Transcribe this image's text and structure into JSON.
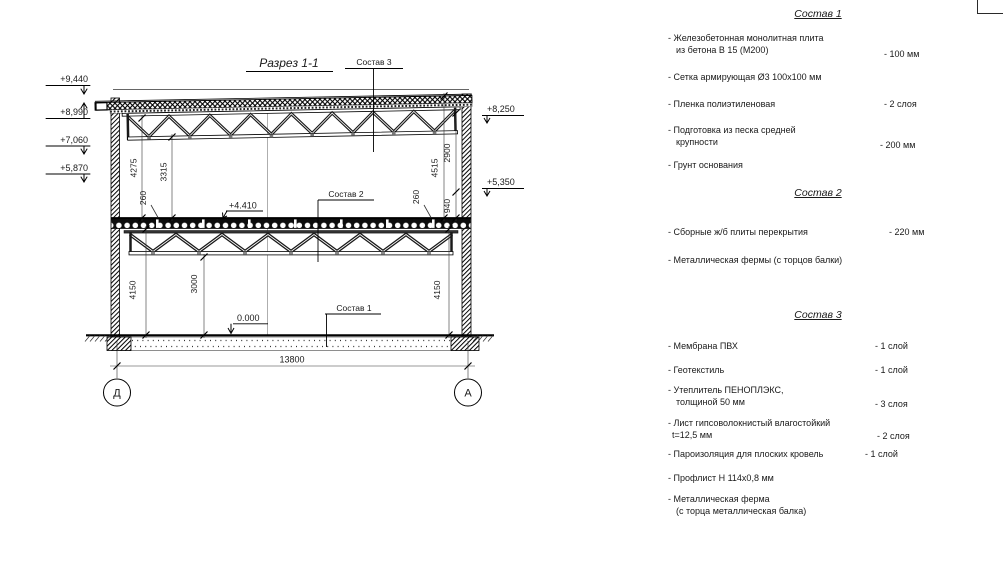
{
  "section": {
    "title": "Разрез 1-1",
    "callouts": {
      "c1": "Состав 1",
      "c2": "Состав 2",
      "c3": "Состав 3"
    },
    "elevations": {
      "e9440": "+9,440",
      "e8990": "+8,990",
      "e7060": "+7,060",
      "e5870": "+5,870",
      "e8250": "+8,250",
      "e5350": "+5,350",
      "e4410": "+4.410",
      "e0": "0.000"
    },
    "dims": {
      "d4275": "4275",
      "d3315": "3315",
      "d260l": "260",
      "d4515": "4515",
      "d2900": "2900",
      "d940": "940",
      "d260r": "260",
      "d4150l": "4150",
      "d3000": "3000",
      "d4150r": "4150",
      "d13800": "13800"
    },
    "axes": {
      "left": "Д",
      "right": "А"
    }
  },
  "specs": [
    {
      "title": "Состав 1",
      "items": [
        {
          "l1": "- Железобетонная  монолитная плита",
          "l2": "из бетона В 15 (М200)",
          "v": "- 100 мм"
        },
        {
          "l1": "- Сетка армирующая Ø3 100x100 мм"
        },
        {
          "l1": "- Пленка полиэтиленовая",
          "v": "- 2 слоя"
        },
        {
          "l1": "- Подготовка из песка средней",
          "l2": "крупности",
          "v": "- 200 мм"
        },
        {
          "l1": "- Грунт основания"
        }
      ]
    },
    {
      "title": "Состав 2",
      "items": [
        {
          "l1": "- Сборные ж/б плиты перекрытия",
          "v": "- 220 мм"
        },
        {
          "l1": "- Металлическая фермы (с торцов балки)"
        }
      ]
    },
    {
      "title": "Состав 3",
      "items": [
        {
          "l1": "- Мембрана ПВХ",
          "v": "- 1 слой"
        },
        {
          "l1": "- Геотекстиль",
          "v": "- 1 слой"
        },
        {
          "l1": "- Утеплитель ПЕНОПЛЭКС,",
          "l2": "толщиной 50 мм",
          "v": "- 3 слоя"
        },
        {
          "l1": "- Лист гипсоволокнистый влагостойкий",
          "l2": "t=12,5 мм",
          "v": "- 2 слоя"
        },
        {
          "l1": "- Пароизоляция для плоских кровель",
          "v": "- 1 слой"
        },
        {
          "l1": "- Профлист Н 114х0,8 мм"
        },
        {
          "l1": "- Металлическая ферма",
          "l2": "(с торца металлическая балка)"
        }
      ]
    }
  ]
}
